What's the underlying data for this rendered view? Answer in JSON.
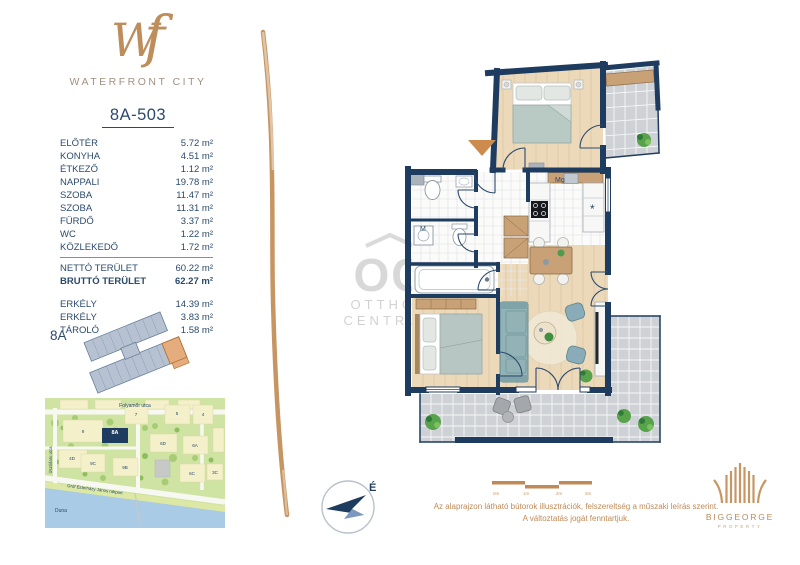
{
  "brand": {
    "monogram_w": "W",
    "monogram_f": "f",
    "name": "WATERFRONT CITY"
  },
  "unit": {
    "id": "8A-503",
    "building": "8A",
    "rooms": [
      {
        "label": "ELŐTÉR",
        "area": "5.72 m²"
      },
      {
        "label": "KONYHA",
        "area": "4.51 m²"
      },
      {
        "label": "ÉTKEZŐ",
        "area": "1.12 m²"
      },
      {
        "label": "NAPPALI",
        "area": "19.78 m²"
      },
      {
        "label": "SZOBA",
        "area": "11.47 m²"
      },
      {
        "label": "SZOBA",
        "area": "11.31 m²"
      },
      {
        "label": "FÜRDŐ",
        "area": "3.37 m²"
      },
      {
        "label": "WC",
        "area": "1.22 m²"
      },
      {
        "label": "KÖZLEKEDŐ",
        "area": "1.72 m²"
      }
    ],
    "totals": [
      {
        "label": "NETTÓ TERÜLET",
        "area": "60.22 m²"
      },
      {
        "label": "BRUTTÓ TERÜLET",
        "area": "62.27 m²"
      }
    ],
    "extras": [
      {
        "label": "ERKÉLY",
        "area": "14.39 m²"
      },
      {
        "label": "ERKÉLY",
        "area": "3.83 m²"
      },
      {
        "label": "TÁROLÓ",
        "area": "1.58 m²"
      }
    ]
  },
  "plan": {
    "labels": {
      "washer": "M",
      "dishwasher": "Mg",
      "fridge": "*"
    },
    "north": "É"
  },
  "map": {
    "street_top": "Folyamőr utca",
    "street_left": "Úszódaru utca",
    "street_river": "Gróf Esterházy János rakpart",
    "river": "Duna",
    "highlight": "8A",
    "blocks": [
      "9",
      "7",
      "5",
      "4",
      "6D",
      "6A",
      "4D",
      "9C",
      "9B",
      "6C",
      "3C"
    ]
  },
  "scalebar": {
    "ticks": [
      "0m",
      "1m",
      "2m",
      "3m"
    ]
  },
  "disclaimer": {
    "line1": "Az alaprajzon látható bútorok illusztrációk, felszereltség a műszaki leírás szerint.",
    "line2": "A változtatás jogát fenntartjuk."
  },
  "watermark": {
    "initials": "OC",
    "line1": "OTTHON",
    "line2": "CENTRUM"
  },
  "developer": {
    "name": "BIGGEORGE",
    "sub": "PROPERTY"
  },
  "colors": {
    "wall_navy": "#1e3c5f",
    "text_navy": "#2b4a6b",
    "accent_tan": "#c08a56",
    "divider_orange": "#d0793b"
  }
}
